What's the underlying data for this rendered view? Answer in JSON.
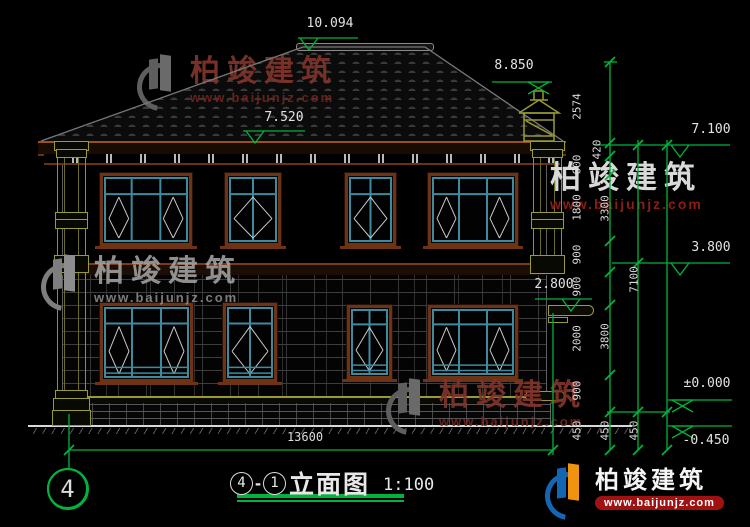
{
  "brand": {
    "name": "柏竣建筑",
    "url": "www.baijunjz.com"
  },
  "title": {
    "grid_bubble": "4",
    "axis_from": "4",
    "separator": "-",
    "axis_to": "1",
    "name": "立面图",
    "scale": "1:100"
  },
  "levels": [
    {
      "text": "10.094",
      "tx": 330,
      "ty": 24,
      "x1": 298,
      "x2": 358,
      "y": 38,
      "sym": "tri",
      "sx": 300
    },
    {
      "text": "8.850",
      "tx": 514,
      "ty": 66,
      "x1": 492,
      "x2": 552,
      "y": 82,
      "sym": "bow",
      "sx": 528
    },
    {
      "text": "7.520",
      "tx": 284,
      "ty": 118,
      "x1": 243,
      "x2": 305,
      "y": 131,
      "sym": "tri",
      "sx": 246
    },
    {
      "text": "2.800",
      "tx": 554,
      "ty": 285,
      "x1": 535,
      "x2": 592,
      "y": 299,
      "sym": "tri",
      "sx": 562
    },
    {
      "text": "7.100",
      "tx": 711,
      "ty": 130,
      "x1": 668,
      "x2": 730,
      "y": 145,
      "sym": "tri",
      "sx": 671
    },
    {
      "text": "3.800",
      "tx": 711,
      "ty": 248,
      "x1": 668,
      "x2": 730,
      "y": 263,
      "sym": "tri",
      "sx": 671
    },
    {
      "text": "±0.000",
      "tx": 707,
      "ty": 384,
      "x1": 668,
      "x2": 732,
      "y": 400,
      "sym": "bow",
      "sx": 672
    },
    {
      "text": "-0.450",
      "tx": 706,
      "ty": 441,
      "x1": 668,
      "x2": 732,
      "y": 426,
      "sym": "bow",
      "sx": 672
    }
  ],
  "dim_chains": [
    {
      "x": 610,
      "y1": 62,
      "y2": 450,
      "ticks": [
        62,
        143,
        156,
        175,
        241,
        272,
        305,
        375,
        412,
        450
      ],
      "labels": [
        {
          "t": "2574",
          "y": 108
        },
        {
          "t": "420",
          "y": 151,
          "dx": 7
        },
        {
          "t": "600",
          "y": 166
        },
        {
          "t": "1800",
          "y": 209
        },
        {
          "t": "900",
          "y": 256
        },
        {
          "t": "900",
          "y": 288
        },
        {
          "t": "2000",
          "y": 340
        },
        {
          "t": "900",
          "y": 392
        },
        {
          "t": "450",
          "y": 432
        }
      ]
    },
    {
      "x": 638,
      "y1": 140,
      "y2": 450,
      "ticks": [
        145,
        263,
        412,
        450
      ],
      "labels": [
        {
          "t": "3300",
          "y": 210
        },
        {
          "t": "3800",
          "y": 338
        },
        {
          "t": "450",
          "y": 432
        }
      ]
    },
    {
      "x": 667,
      "y1": 140,
      "y2": 450,
      "ticks": [
        145,
        412,
        450
      ],
      "labels": [
        {
          "t": "7100",
          "y": 281
        },
        {
          "t": "450",
          "y": 432
        }
      ]
    }
  ],
  "dim_bottom": {
    "text": "13600",
    "x1": 69,
    "x2": 553,
    "y": 450,
    "tx": 305,
    "ty": 437
  },
  "windows": [
    {
      "x": 100,
      "y": 173,
      "w": 92,
      "h": 73,
      "style": "w3"
    },
    {
      "x": 225,
      "y": 173,
      "w": 56,
      "h": 73,
      "style": "w2"
    },
    {
      "x": 345,
      "y": 173,
      "w": 51,
      "h": 73,
      "style": "w2"
    },
    {
      "x": 428,
      "y": 173,
      "w": 90,
      "h": 73,
      "style": "w3"
    },
    {
      "x": 100,
      "y": 303,
      "w": 93,
      "h": 79,
      "style": "f3"
    },
    {
      "x": 223,
      "y": 303,
      "w": 54,
      "h": 79,
      "style": "f2"
    },
    {
      "x": 347,
      "y": 305,
      "w": 45,
      "h": 74,
      "style": "f2"
    },
    {
      "x": 428,
      "y": 305,
      "w": 90,
      "h": 74,
      "style": "f3"
    }
  ],
  "watermarks": [
    {
      "style": "maroon",
      "x": 136,
      "y": 52,
      "logo": true
    },
    {
      "style": "gray",
      "x": 40,
      "y": 252,
      "logo": true
    },
    {
      "style": "white",
      "x": 550,
      "y": 162,
      "logo": false
    },
    {
      "style": "maroon",
      "x": 385,
      "y": 376,
      "logo": true
    },
    {
      "style": "badge",
      "x": 544,
      "y": 461,
      "logo": true
    }
  ],
  "colors": {
    "dim_green": "#00b33c",
    "frame_brown": "#6e3214",
    "sash_teal": "#3e8ba0",
    "trim_olive": "#9a9a33"
  }
}
